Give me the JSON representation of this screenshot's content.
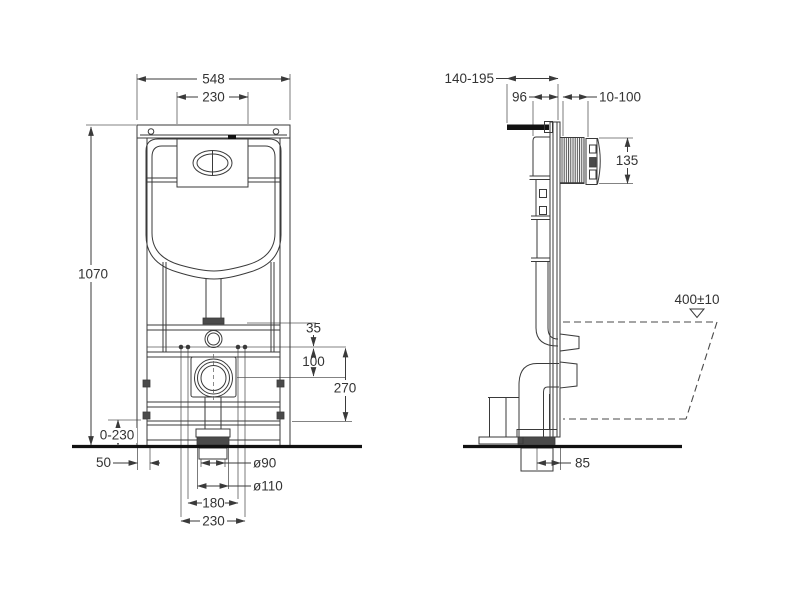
{
  "drawing": {
    "type": "technical-installation-diagram",
    "subject": "concealed-cistern-wc-frame",
    "colors": {
      "background": "#ffffff",
      "line": "#3a3a3a",
      "text": "#333333",
      "floor_line": "#111111",
      "dark_fill": "#4a4a4a"
    },
    "front_view": {
      "labels": {
        "overall_width": "548",
        "flush_plate_width": "230",
        "overall_height": "1070",
        "leg_adjustment": "0-230",
        "side_offset": "50",
        "drain_diameter": "ø90",
        "pipe_diameter": "ø110",
        "bolt_spacing_inner": "180",
        "bolt_spacing_outer": "230",
        "supply_offset": "35",
        "outlet_drop": "100",
        "outlet_height": "270"
      }
    },
    "side_view": {
      "labels": {
        "depth_range": "140-195",
        "frame_depth": "96",
        "wall_thickness_range": "10-100",
        "access_opening_height": "135",
        "bowl_top_height": "400±10",
        "drain_wall_offset": "85"
      }
    }
  }
}
